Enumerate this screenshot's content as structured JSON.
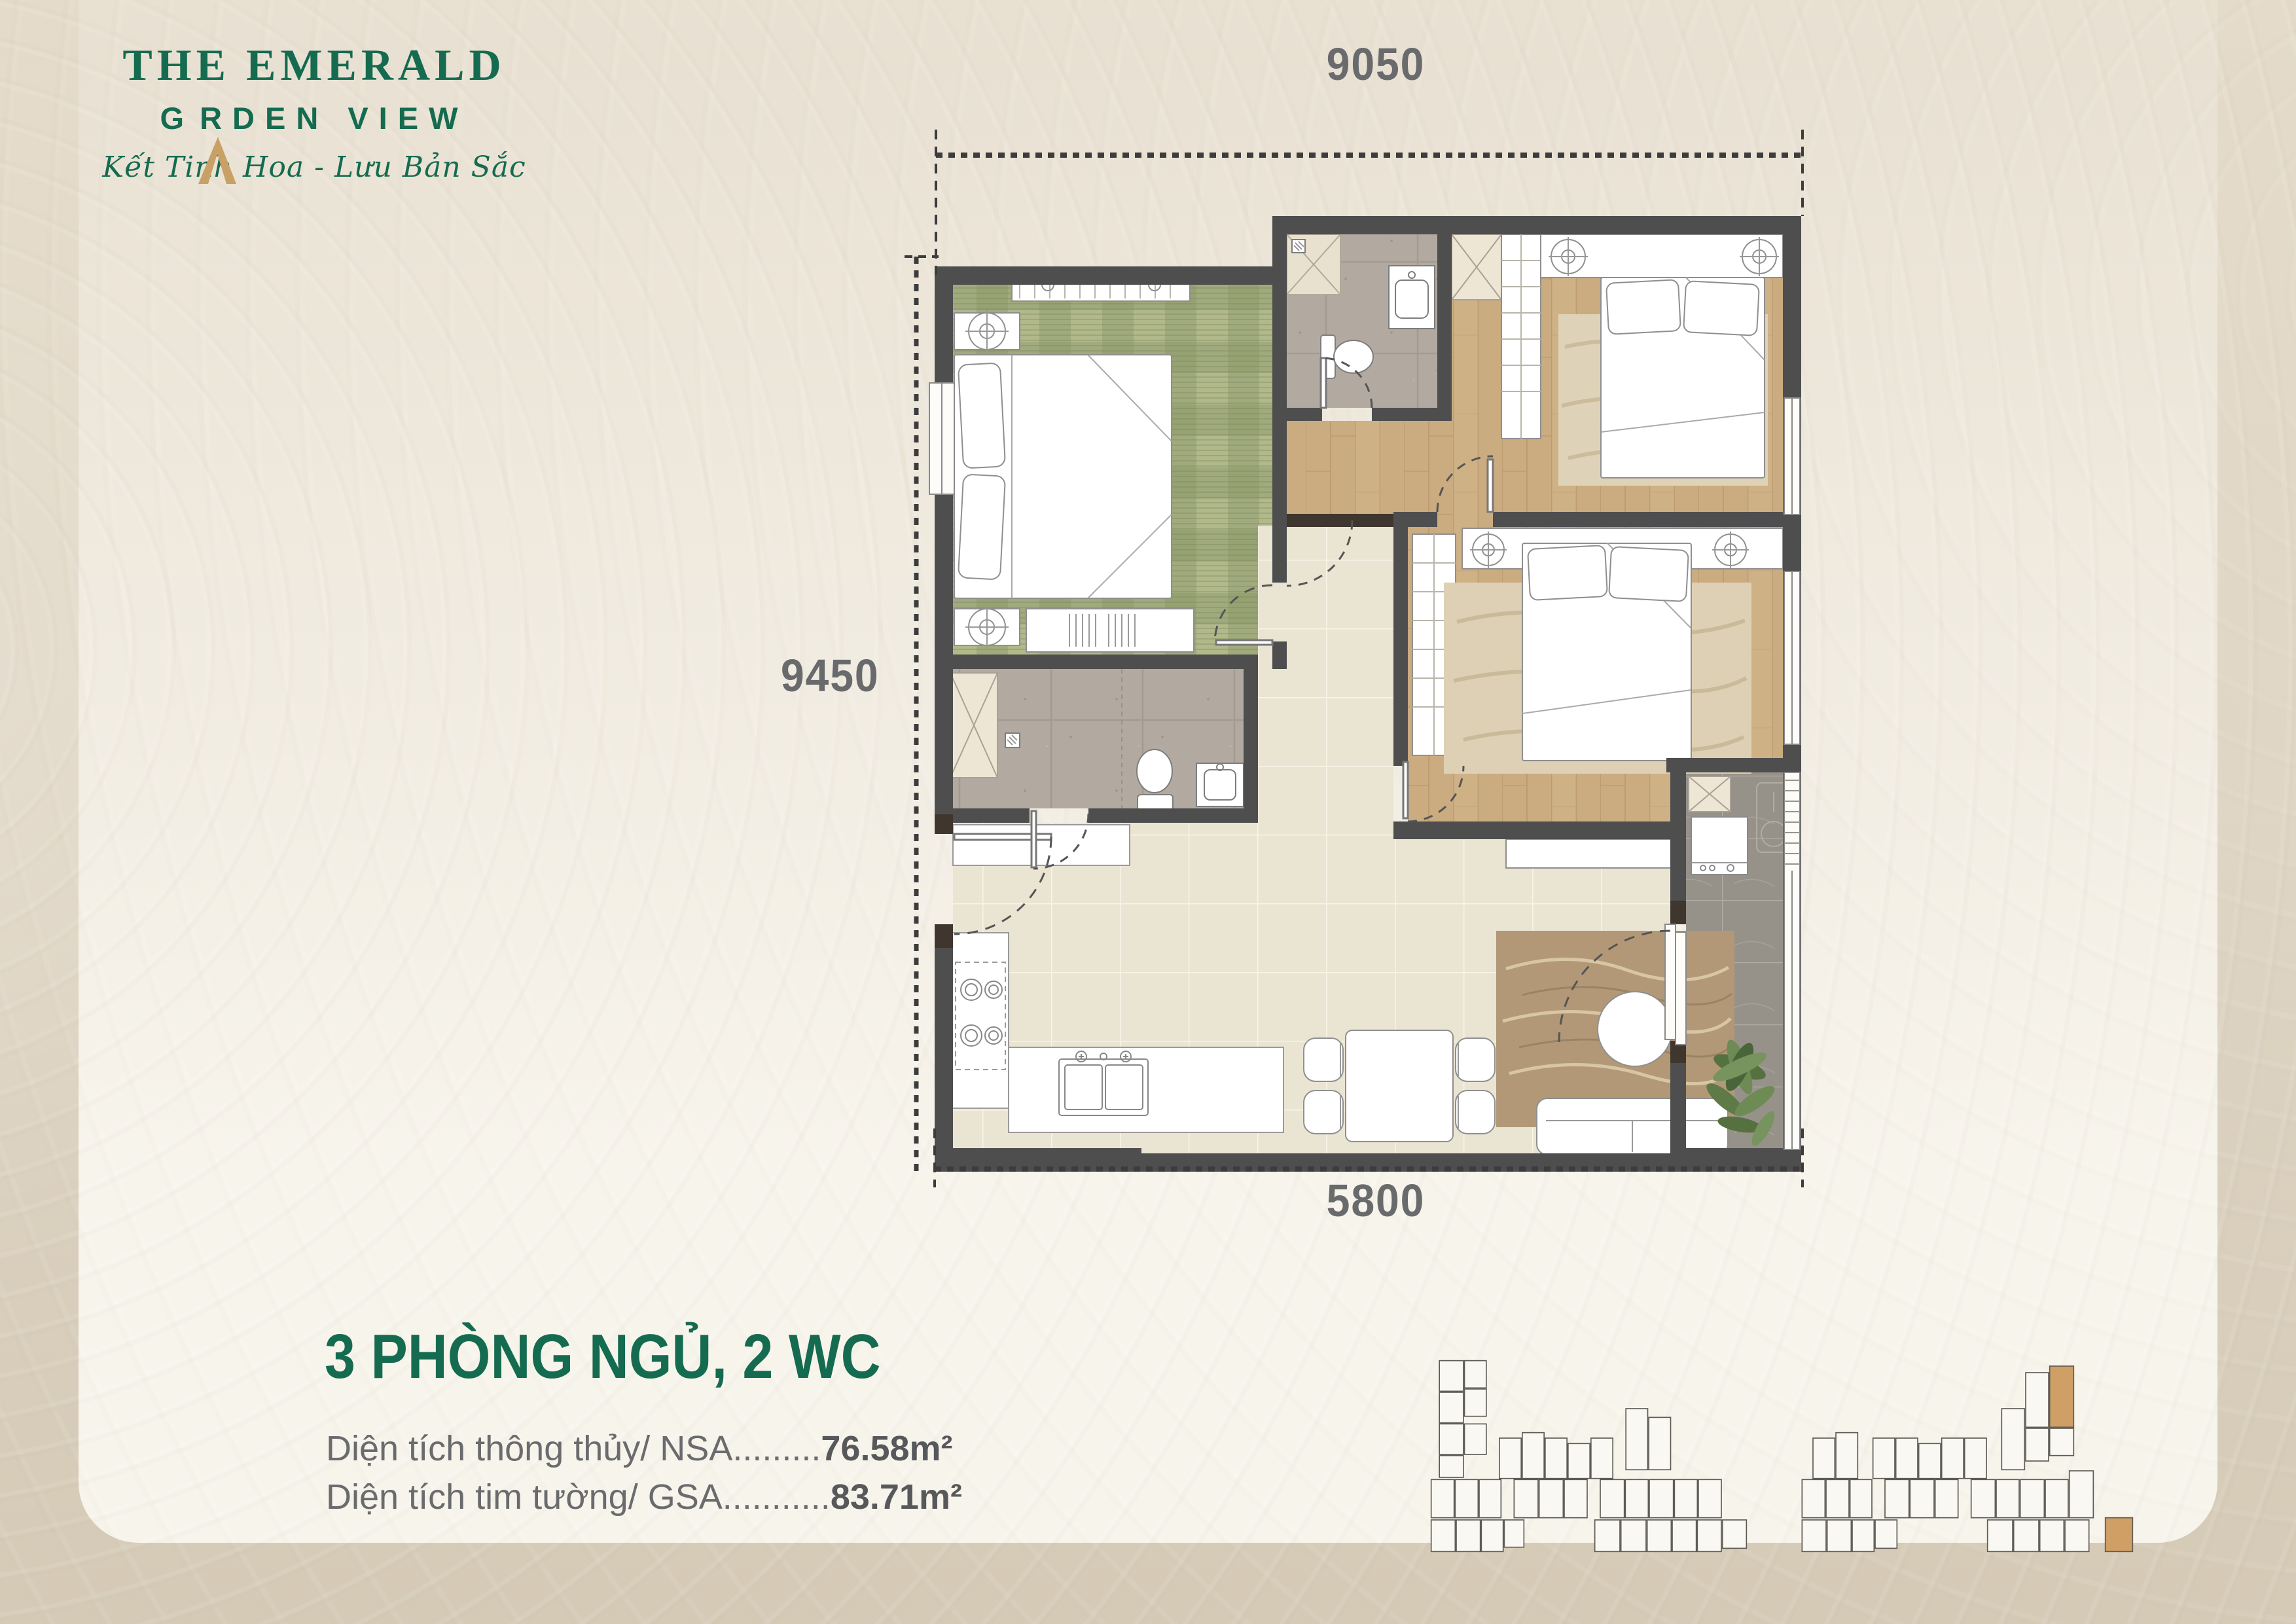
{
  "brand": {
    "line1": "THE EMERALD",
    "line2_prefix": "G",
    "line2_suffix": "RDEN VIEW",
    "tagline": "Kết Tinh Hoa - Lưu Bản Sắc"
  },
  "dimensions": {
    "top": "9050",
    "left": "9450",
    "bottom": "5800"
  },
  "unit": {
    "title": "3 PHÒNG NGỦ, 2 WC",
    "areas": [
      {
        "label": "Diện tích thông thủy/ NSA",
        "dots": ".........",
        "value": "76.58m²"
      },
      {
        "label": "Diện tích tim tường/ GSA",
        "dots": "...........",
        "value": "83.71m²"
      }
    ]
  },
  "site_key": {
    "highlighted_units": 2,
    "icon": "building-footprint-key"
  },
  "colors": {
    "brand_green": "#156b50",
    "logo_gold": "#c9a065",
    "text_gray": "#6a6b6d",
    "value_gray": "#57585a",
    "wall_gray": "#4e4e4e",
    "highlight_tan": "#cf9f66",
    "panel_cream": "#f7f4ec",
    "bg_beige": "#ddd3c2",
    "dim_line": "#3c3c3c"
  }
}
